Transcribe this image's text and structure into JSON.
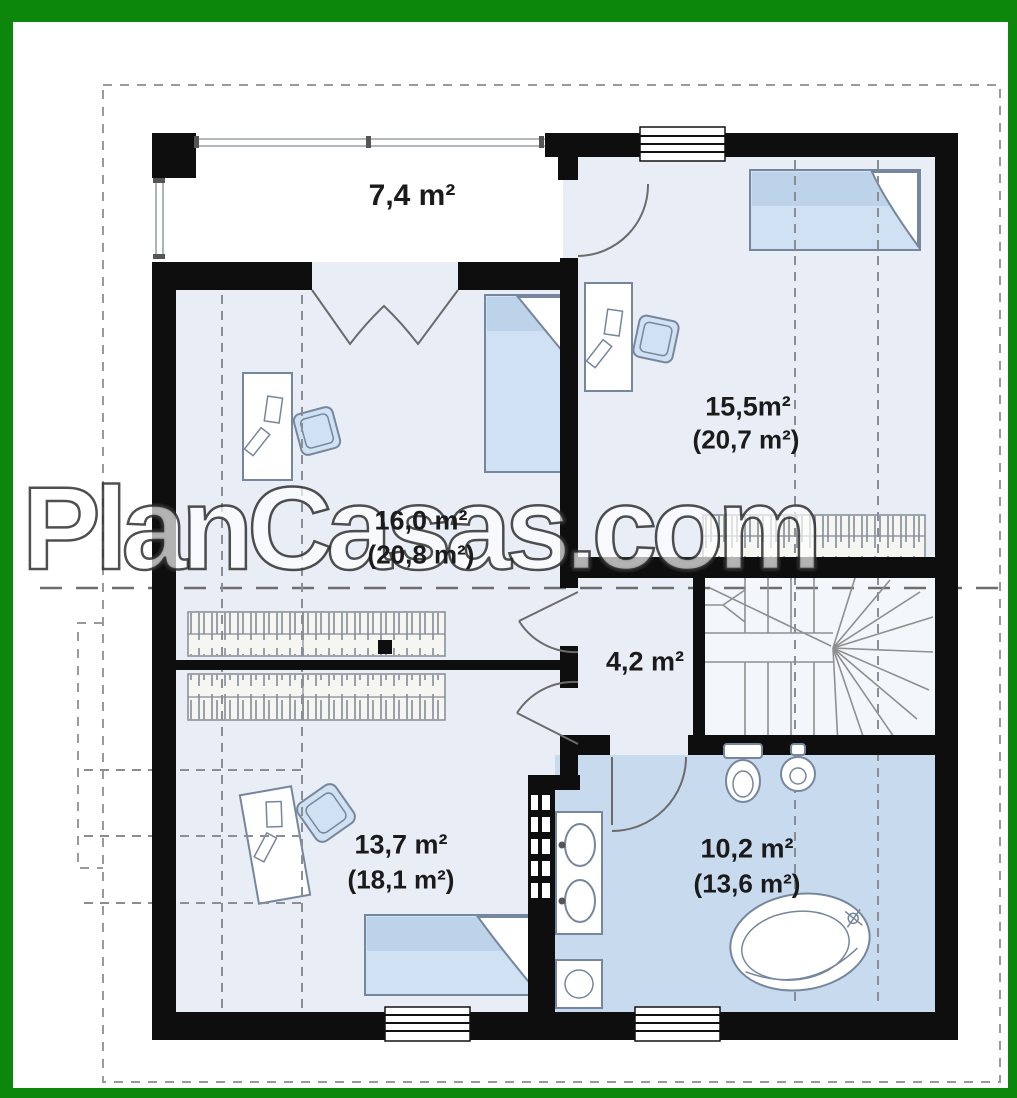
{
  "watermark": {
    "text": "PlanCasas.com"
  },
  "rooms": {
    "balcony": {
      "area": "7,4 m²"
    },
    "bedroom_top_right": {
      "area": "15,5m²",
      "area_gross": "(20,7 m²)"
    },
    "room_middle_left": {
      "area": "16,0 m²",
      "area_gross": "(20,8 m²)"
    },
    "hall": {
      "area": "4,2 m²"
    },
    "bedroom_bottom_left": {
      "area": "13,7 m²",
      "area_gross": "(18,1 m²)"
    },
    "bathroom": {
      "area": "10,2 m²",
      "area_gross": "(13,6 m²)"
    }
  },
  "colors": {
    "frame_green": "#0c870c",
    "wall_black": "#0e0e0e",
    "room_fill": "#e8edf6",
    "bath_fill": "#c8daee",
    "bed_fill": "#cfe1f2",
    "bed_band": "#bcd3ea",
    "furniture_line": "#76879d",
    "dash_gray": "#8a8f96",
    "stair_line": "#8f8f8f",
    "label_color": "#1b1b1b",
    "wardrobe_fill": "#f5f6f2"
  }
}
